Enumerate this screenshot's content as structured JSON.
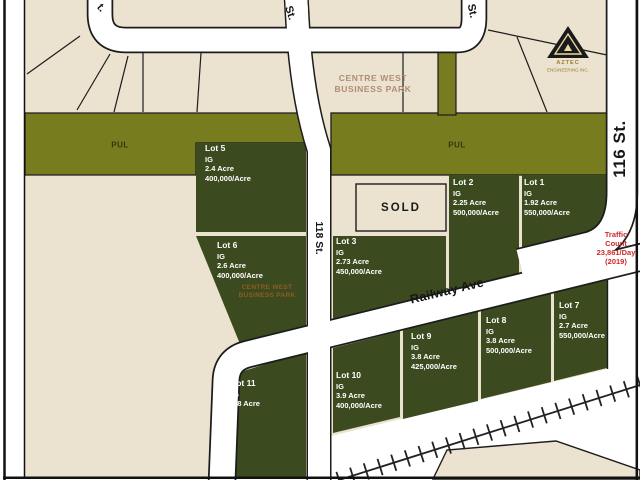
{
  "map": {
    "title_park": {
      "line1": "CENTRE WEST",
      "line2": "BUSINESS PARK"
    },
    "lot6_park": {
      "line1": "CENTRE WEST",
      "line2": "BUSINESS PARK"
    },
    "streets": {
      "top_left_partial": "t.",
      "top_mid": "St.",
      "top_right": "St.",
      "st_118": "118 St.",
      "st_116": "116 St.",
      "railway": "Railway Ave"
    },
    "pul_left": "PUL",
    "pul_right": "PUL",
    "sold": "SOLD",
    "traffic": {
      "line1": "Traffic",
      "line2": "Count",
      "line3": "23,861/Day",
      "line4": "(2019)"
    },
    "logo": {
      "line1": "AZTEC",
      "line2": "ENGINEERING INC."
    },
    "lots": [
      {
        "name": "Lot 5",
        "zoning": "IG",
        "area": "2.4 Acre",
        "price": "400,000/Acre"
      },
      {
        "name": "Lot 6",
        "zoning": "IG",
        "area": "2.6 Acre",
        "price": "400,000/Acre"
      },
      {
        "name": "Lot 3",
        "zoning": "IG",
        "area": "2.73 Acre",
        "price": "450,000/Acre"
      },
      {
        "name": "Lot 2",
        "zoning": "IG",
        "area": "2.25 Acre",
        "price": "500,000/Acre"
      },
      {
        "name": "Lot 1",
        "zoning": "IG",
        "area": "1.92 Acre",
        "price": "550,000/Acre"
      },
      {
        "name": "Lot 7",
        "zoning": "IG",
        "area": "2.7 Acre",
        "price": "550,000/Acre"
      },
      {
        "name": "Lot 8",
        "zoning": "IG",
        "area": "3.8 Acre",
        "price": "500,000/Acre"
      },
      {
        "name": "Lot 9",
        "zoning": "IG",
        "area": "3.8 Acre",
        "price": "425,000/Acre"
      },
      {
        "name": "Lot 10",
        "zoning": "IG",
        "area": "3.9 Acre",
        "price": "400,000/Acre"
      },
      {
        "name": "Lot 11",
        "zoning": "IG",
        "area": "3.8 Acre",
        "price": ""
      }
    ],
    "colors": {
      "beige": "#ebe3d0",
      "olive_pul": "#777d1f",
      "dark_green_lot": "#3c4a1f",
      "street_white": "#ffffff",
      "line_black": "#1c1c1c",
      "traffic_red": "#cc2a2a",
      "park_text": "#b18c74",
      "lot6_park_text": "#8f5c20"
    }
  }
}
